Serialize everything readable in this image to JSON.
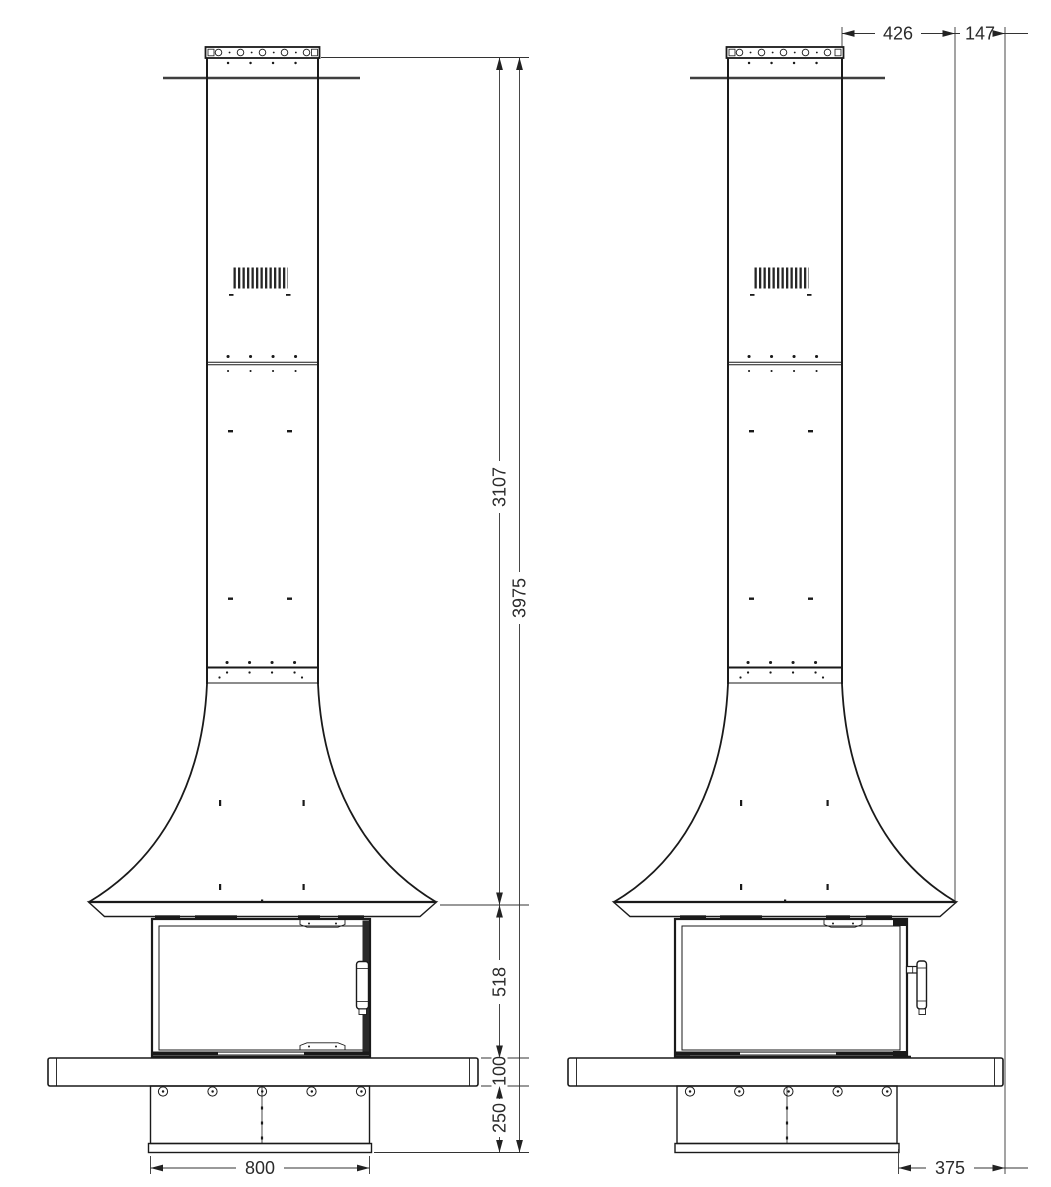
{
  "colors": {
    "line": "#1a1a1a",
    "dimension_line": "#333333",
    "ceiling_line": "#3f3f3f",
    "background": "#ffffff",
    "text": "#2b2b2b"
  },
  "front_view": {
    "dimensions": {
      "chimney_height": "3107",
      "overall_height": "3975",
      "firebox_zone_height": "518",
      "bench_thickness": "100",
      "plinth_height": "250",
      "base_width": "800"
    }
  },
  "side_view": {
    "dimensions": {
      "hood_overhang": "426",
      "hood_to_wall": "147",
      "base_depth": "375"
    }
  }
}
